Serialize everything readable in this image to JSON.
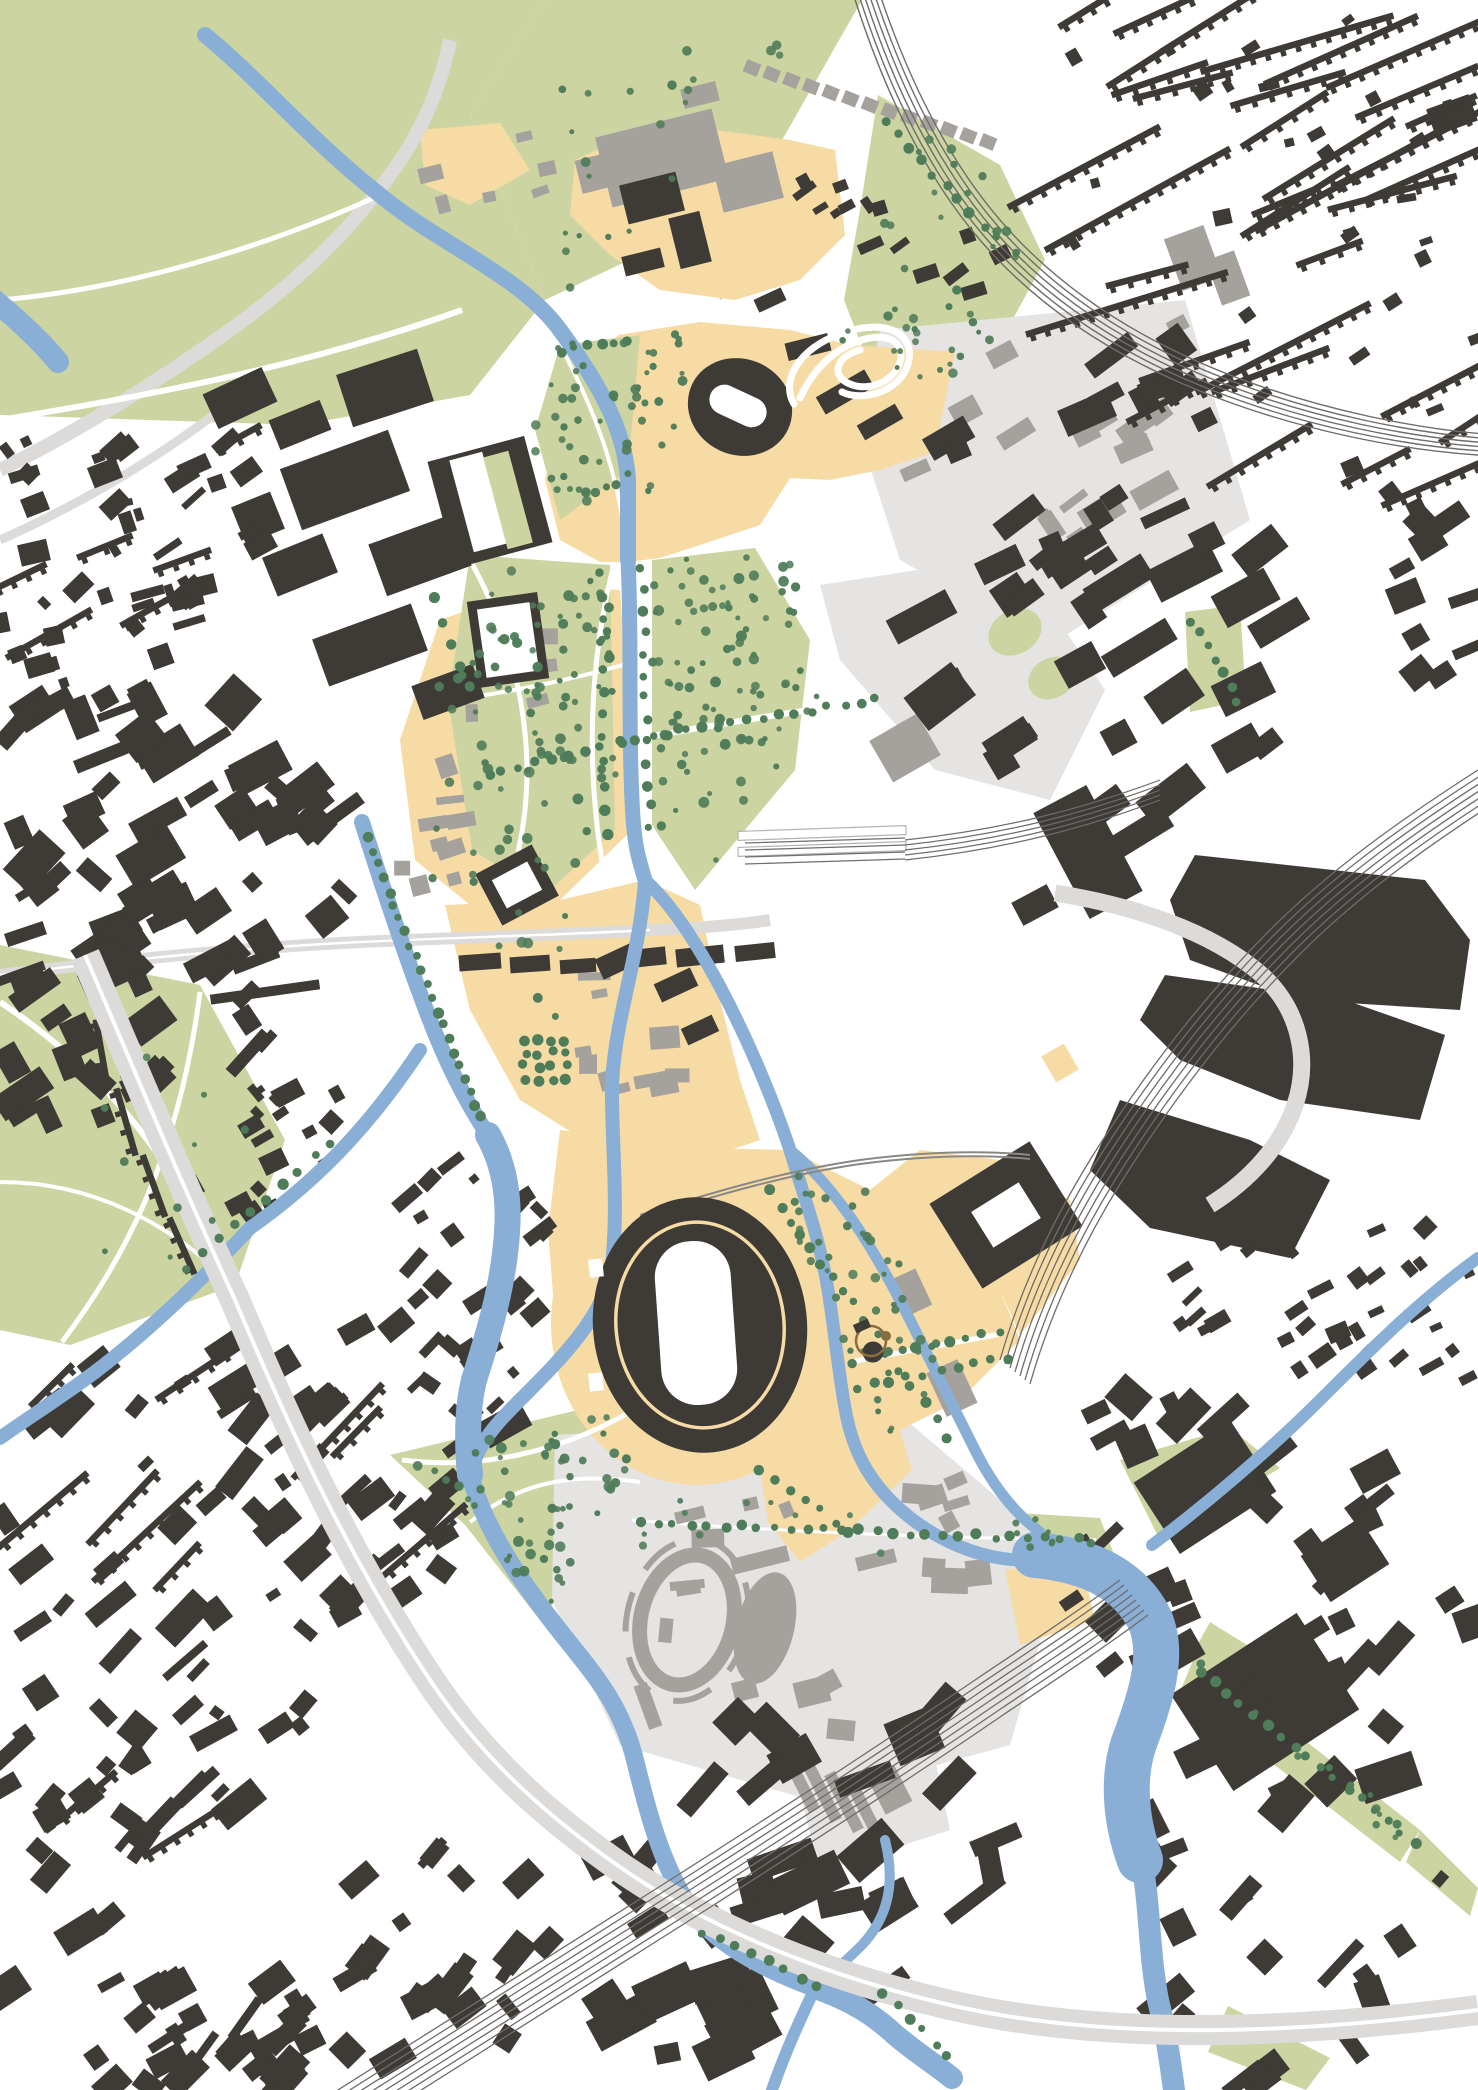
{
  "palette": {
    "background": "#ffffff",
    "parkland": "#ccd5a1",
    "water": "#8aafd7",
    "plaza": "#f7dba4",
    "building_primary": "#3e3b37",
    "building_secondary": "#a5a29e",
    "district_paving": "#e6e4e2",
    "road": "#dcdbd9",
    "road_centerline": "#ffffff",
    "rail": "#6f6c69",
    "rail_light": "#8a8885",
    "tree": "#4f7c59",
    "monument_bronze": "#8a6d3f",
    "stadium_ring_line": "#f7dba4",
    "infield": "#ffffff"
  },
  "map": {
    "kind": "urban-masterplan-figure-ground-plan",
    "view": "top-down plan, no labels or text visible",
    "landmarks": [
      {
        "id": "main-stadium",
        "kind": "large oval stadium with white infield and inner ring line"
      },
      {
        "id": "athletics-track-stadium",
        "kind": "smaller oval stadium with white infield, north area"
      },
      {
        "id": "serpentine-track",
        "kind": "white looping hairpin track beside north stadium"
      },
      {
        "id": "warmup-track-ring",
        "kind": "grey oval running-track ring, south district"
      },
      {
        "id": "warmup-field-oval",
        "kind": "solid grey oval field, south district"
      },
      {
        "id": "courtyard-arena",
        "kind": "dark building with white courtyard, north-east of main stadium"
      },
      {
        "id": "courtyard-hall",
        "kind": "dark-framed white courtyard hall on west spine"
      },
      {
        "id": "striped-roof-hall",
        "kind": "dark hall with white and green striped roof, north-west"
      },
      {
        "id": "monument",
        "kind": "small ornate monument drawing east of main stadium"
      },
      {
        "id": "rail-station",
        "kind": "platforms and fanning tracks, centre-east"
      }
    ],
    "layers": [
      "parkland",
      "district-paving",
      "plaza-spine",
      "lawns",
      "roads",
      "secondary-buildings",
      "primary-buildings",
      "water",
      "overpass-roads",
      "railways",
      "landmarks",
      "trees",
      "monument"
    ]
  }
}
